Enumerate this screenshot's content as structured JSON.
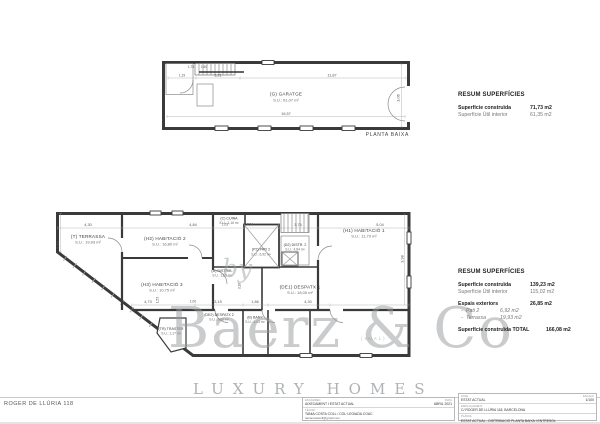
{
  "sheet": {
    "project_ref": "ROGER DE LLÚRIA 118"
  },
  "watermark": {
    "by": "by",
    "brand": "Baerz & Co",
    "tagline": "LUXURY HOMES"
  },
  "plan_top": {
    "caption": "PLANTA BAIXA",
    "room_code": "(G) GARATGE",
    "room_area": "S.U.: 61,07 m²",
    "dims": {
      "a": "1,19",
      "b": "3,21",
      "c": "11,87",
      "d": "16,57",
      "e": "3,06",
      "f": "1,78",
      "g": "1,50"
    }
  },
  "plan_bottom": {
    "rooms": [
      {
        "code": "(T) TERRASSA",
        "area": "S.U.: 19,93 m²"
      },
      {
        "code": "(H2) HABITACIÓ 2",
        "area": "S.U.: 16,80 m²"
      },
      {
        "code": "(H3) HABITACIÓ 3",
        "area": "S.U.: 10,75 m²"
      },
      {
        "code": "(C) CUINA",
        "area": "S.U.: 1,16 m²"
      },
      {
        "code": "(P2) PATI 2",
        "area": "S.U.: 6,92 m²"
      },
      {
        "code": "(D2) DISTR. 2",
        "area": "S.U.: 4,84 m²"
      },
      {
        "code": "(D) DISTRIB.",
        "area": "S.U.: 12,5 m²"
      },
      {
        "code": "(H1) HABITACIÓ 1",
        "area": "S.U.: 11,79 m²"
      },
      {
        "code": "(DE1) DESPATX 1",
        "area": "S.U.: 18,00 m²"
      },
      {
        "code": "(DE2) DESPATX 2",
        "area": "S.U.: 9,06 m²"
      },
      {
        "code": "(B) BANY",
        "area": "S.U.: 4,03 m²"
      },
      {
        "code": "(TR) TRASTER",
        "area": "S.U.: 1,17 m²"
      },
      {
        "code": "( SALA 1 )",
        "area": ""
      }
    ],
    "dims": {
      "t1": "4,30",
      "t2": "4,84",
      "t3": "1,03",
      "t4": "2,94",
      "t5": "3,74",
      "t6": "5,04",
      "l1": "5,85",
      "b1": "4,73",
      "b2": "1,00",
      "b3": "3,15",
      "b4": "1,86",
      "b5": "4,30",
      "v1": "3,18",
      "v2": "1,53",
      "v3": "3,98"
    }
  },
  "resum_top": {
    "title": "RESUM SUPERFÍCIES",
    "construida_label": "Superfície construïda",
    "construida_value": "71,73 m2",
    "util_label": "Superfície Útil interior",
    "util_value": "61,35 m2"
  },
  "resum_bottom": {
    "title": "RESUM SUPERFÍCIES",
    "construida_label": "Superfície construïda",
    "construida_value": "139,23 m2",
    "util_label": "Superfície Útil interior",
    "util_value": "115,02 m2",
    "exteriors_label": "Espais exteriors",
    "exteriors_value": "26,85 m2",
    "dash": "-",
    "pati_label": "Pati 2",
    "pati_value": "6,92 m2",
    "terrassa_label": "Terrassa",
    "terrassa_value": "19,93 m2",
    "total_label": "Superfície construïda TOTAL",
    "total_value": "166,08 m2"
  },
  "titleblock": {
    "left": {
      "row1_label": "ENCÀRREC",
      "row1_value": "AIXECAMENT I ESTAT ACTUAL",
      "row2_label": "TÈCNIC",
      "row2_value": "TANIA COSTA COLL / COL·LEGIADA COAC",
      "row2_email": "taniacostacoll@gmail.com",
      "date_label": "DATA",
      "date_value": "ABRIL 2021"
    },
    "right": {
      "fase_label": "FASE",
      "fase_value": "ESTAT ACTUAL",
      "escala_label": "ESCALA",
      "escala_value": "1/100",
      "adreca_label": "EMPLAÇAMENT",
      "adreca_value": "C/ ROGER DE LLÚRIA 118, BARCELONA",
      "planol_label": "PLÀNOL",
      "planol_value": "ESTAT ACTUAL - DISTRIBUCIÓ PLANTA BAIXA I ENTRESOL",
      "num_label": "NÚM.",
      "num_value": "DG A3"
    }
  }
}
